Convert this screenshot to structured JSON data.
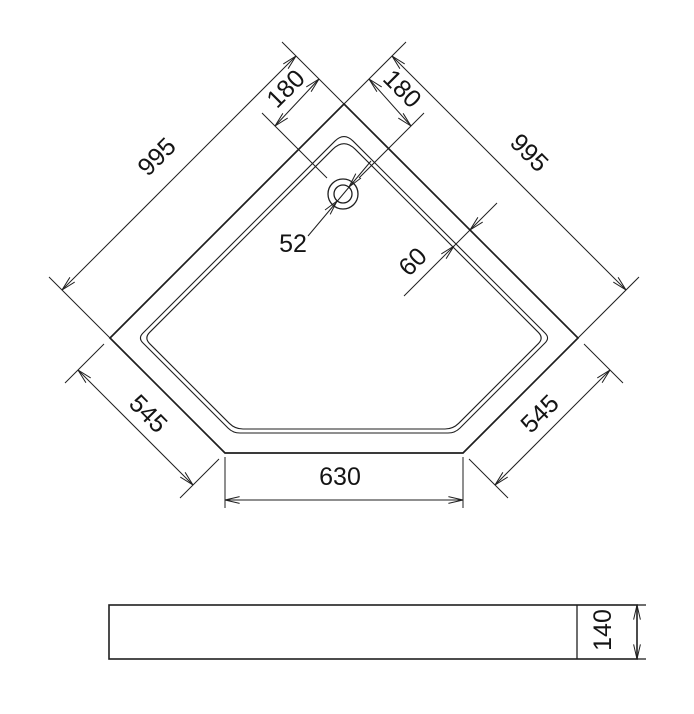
{
  "drawing": {
    "title": "corner shower tray dimension drawing",
    "colors": {
      "background": "#ffffff",
      "line": "#1f1f1f",
      "text": "#141414"
    },
    "dimensions": {
      "labels": {
        "side_995_left": "995",
        "side_995_right": "995",
        "offset_180_left": "180",
        "offset_180_right": "180",
        "chamfer_545_left": "545",
        "chamfer_545_right": "545",
        "front_630": "630",
        "drain_52": "52",
        "rim_60": "60",
        "height_140": "140"
      },
      "values": {
        "back_sides": 995,
        "drain_offset_each_side": 180,
        "chamfer_sides": 545,
        "front_edge": 630,
        "drain_diameter": 52,
        "rim_width": 60,
        "tray_height": 140
      }
    },
    "svg": {
      "width": 694,
      "height": 714,
      "font_size": 25,
      "arrow": {
        "length": 15,
        "half_angle_deg": 13
      },
      "primitives": [
        {
          "t": "path",
          "name": "tray-outline-outer",
          "d": "M344,104 L578,338 L463,453 L225,453 L110,338 Z",
          "sw": 1.7
        },
        {
          "t": "rpath",
          "name": "tray-rim-outer-line",
          "pts": [
            [
              344,
              132
            ],
            [
              550,
              338
            ],
            [
              455,
              433
            ],
            [
              233,
              433
            ],
            [
              138,
              338
            ]
          ],
          "r": [
            13,
            7,
            7,
            7,
            7
          ],
          "sw": 1.1
        },
        {
          "t": "rpath",
          "name": "tray-rim-inner-line",
          "pts": [
            [
              344,
              138
            ],
            [
              544,
              338
            ],
            [
              453,
              429
            ],
            [
              235,
              429
            ],
            [
              144,
              338
            ]
          ],
          "r": [
            16,
            8,
            8,
            8,
            8
          ],
          "sw": 1.1
        },
        {
          "t": "circle",
          "name": "drain-outer-circle",
          "c": [
            343,
            194
          ],
          "r": 15,
          "sw": 1.3
        },
        {
          "t": "circle",
          "name": "drain-inner-circle",
          "c": [
            343,
            194
          ],
          "r": 9,
          "sw": 1.3
        },
        {
          "t": "line",
          "name": "ext-line-apex-left",
          "p": [
            344,
            104,
            282,
            42
          ],
          "sw": 1
        },
        {
          "t": "line",
          "name": "ext-line-apex-right",
          "p": [
            344,
            104,
            406,
            42
          ],
          "sw": 1
        },
        {
          "t": "line",
          "name": "ext-line-drain-left",
          "p": [
            327,
            178,
            262,
            113
          ],
          "sw": 1
        },
        {
          "t": "line",
          "name": "ext-line-drain-right",
          "p": [
            359,
            178,
            424,
            113
          ],
          "sw": 1
        },
        {
          "t": "line",
          "name": "dim-line-180-left",
          "p": [
            275,
            126,
            319,
            79
          ],
          "sw": 1
        },
        {
          "t": "line",
          "name": "dim-line-180-right",
          "p": [
            369,
            79,
            411,
            126
          ],
          "sw": 1
        },
        {
          "t": "line",
          "name": "dim-line-995-left",
          "p": [
            62,
            290,
            296,
            56
          ],
          "sw": 1
        },
        {
          "t": "line",
          "name": "ext-line-995-left-vertex",
          "p": [
            110,
            338,
            49,
            277
          ],
          "sw": 1
        },
        {
          "t": "line",
          "name": "dim-line-995-right",
          "p": [
            392,
            56,
            626,
            290
          ],
          "sw": 1
        },
        {
          "t": "line",
          "name": "ext-line-995-right-vertex",
          "p": [
            578,
            338,
            639,
            277
          ],
          "sw": 1
        },
        {
          "t": "line",
          "name": "dim-line-545-left",
          "p": [
            78,
            370,
            193,
            485
          ],
          "sw": 1
        },
        {
          "t": "line",
          "name": "ext-line-545-left-top",
          "p": [
            104,
            344,
            65,
            383
          ],
          "sw": 1
        },
        {
          "t": "line",
          "name": "ext-line-545-left-bottom",
          "p": [
            219,
            459,
            180,
            498
          ],
          "sw": 1
        },
        {
          "t": "line",
          "name": "dim-line-545-right",
          "p": [
            610,
            370,
            495,
            485
          ],
          "sw": 1
        },
        {
          "t": "line",
          "name": "ext-line-545-right-top",
          "p": [
            584,
            344,
            623,
            383
          ],
          "sw": 1
        },
        {
          "t": "line",
          "name": "ext-line-545-right-bottom",
          "p": [
            469,
            459,
            508,
            498
          ],
          "sw": 1
        },
        {
          "t": "line",
          "name": "ext-line-630-left",
          "p": [
            225,
            457,
            225,
            508
          ],
          "sw": 1
        },
        {
          "t": "line",
          "name": "ext-line-630-right",
          "p": [
            463,
            457,
            463,
            508
          ],
          "sw": 1
        },
        {
          "t": "line",
          "name": "dim-line-630",
          "p": [
            225,
            500,
            463,
            500
          ],
          "sw": 1
        },
        {
          "t": "line",
          "name": "leader-line-52",
          "p": [
            308,
            236,
            371,
            161
          ],
          "sw": 1
        },
        {
          "t": "line",
          "name": "dim-line-60",
          "p": [
            404,
            296,
            497,
            203
          ],
          "sw": 1
        },
        {
          "t": "arrow",
          "name": "arrowhead-995-left-top",
          "tip": [
            296,
            56
          ],
          "a": -45
        },
        {
          "t": "arrow",
          "name": "arrowhead-995-left-bottom",
          "tip": [
            62,
            290
          ],
          "a": 135
        },
        {
          "t": "arrow",
          "name": "arrowhead-995-right-top",
          "tip": [
            392,
            56
          ],
          "a": -135
        },
        {
          "t": "arrow",
          "name": "arrowhead-995-right-bottom",
          "tip": [
            626,
            290
          ],
          "a": 45
        },
        {
          "t": "arrow",
          "name": "arrowhead-180-left-top",
          "tip": [
            319,
            79
          ],
          "a": -45
        },
        {
          "t": "arrow",
          "name": "arrowhead-180-left-bottom",
          "tip": [
            275,
            126
          ],
          "a": 135
        },
        {
          "t": "arrow",
          "name": "arrowhead-180-right-top",
          "tip": [
            369,
            79
          ],
          "a": -135
        },
        {
          "t": "arrow",
          "name": "arrowhead-180-right-bottom",
          "tip": [
            411,
            126
          ],
          "a": 45
        },
        {
          "t": "arrow",
          "name": "arrowhead-545-left-top",
          "tip": [
            78,
            370
          ],
          "a": -135
        },
        {
          "t": "arrow",
          "name": "arrowhead-545-left-bottom",
          "tip": [
            193,
            485
          ],
          "a": 45
        },
        {
          "t": "arrow",
          "name": "arrowhead-545-right-top",
          "tip": [
            610,
            370
          ],
          "a": -45
        },
        {
          "t": "arrow",
          "name": "arrowhead-545-right-bottom",
          "tip": [
            495,
            485
          ],
          "a": 135
        },
        {
          "t": "arrow",
          "name": "arrowhead-630-left",
          "tip": [
            225,
            500
          ],
          "a": 180
        },
        {
          "t": "arrow",
          "name": "arrowhead-630-right",
          "tip": [
            463,
            500
          ],
          "a": 0
        },
        {
          "t": "arrow",
          "name": "arrowhead-52-lower",
          "tip": [
            337,
            201
          ],
          "a": -50
        },
        {
          "t": "arrow",
          "name": "arrowhead-52-upper",
          "tip": [
            349,
            187
          ],
          "a": 130
        },
        {
          "t": "arrow",
          "name": "arrowhead-60-outer",
          "tip": [
            470,
            230
          ],
          "a": 135
        },
        {
          "t": "arrow",
          "name": "arrowhead-60-inner",
          "tip": [
            454,
            246
          ],
          "a": -45
        },
        {
          "t": "rect",
          "name": "side-view-body",
          "x": 109,
          "y": 605,
          "w": 528,
          "h": 54,
          "sw": 1.6
        },
        {
          "t": "line",
          "name": "side-view-divider",
          "p": [
            577,
            605,
            577,
            659
          ],
          "sw": 1.3
        },
        {
          "t": "line",
          "name": "side-view-top-overshoot",
          "p": [
            637,
            605,
            646,
            605
          ],
          "sw": 1.3
        },
        {
          "t": "line",
          "name": "side-view-bottom-overshoot",
          "p": [
            637,
            659,
            646,
            659
          ],
          "sw": 1.3
        },
        {
          "t": "line",
          "name": "dim-line-140",
          "p": [
            637,
            605,
            637,
            659
          ],
          "sw": 1
        },
        {
          "t": "arrow",
          "name": "arrowhead-140-top",
          "tip": [
            637,
            605
          ],
          "a": -90
        },
        {
          "t": "arrow",
          "name": "arrowhead-140-bottom",
          "tip": [
            637,
            659
          ],
          "a": 90
        },
        {
          "t": "text",
          "name": "dim-label-995-left",
          "c": [
            157,
            157
          ],
          "rot": -45,
          "bind": "drawing.dimensions.labels.side_995_left"
        },
        {
          "t": "text",
          "name": "dim-label-995-right",
          "c": [
            529,
            153
          ],
          "rot": 45,
          "bind": "drawing.dimensions.labels.side_995_right"
        },
        {
          "t": "text",
          "name": "dim-label-180-left",
          "c": [
            286,
            89
          ],
          "rot": -45,
          "bind": "drawing.dimensions.labels.offset_180_left"
        },
        {
          "t": "text",
          "name": "dim-label-180-right",
          "c": [
            402,
            89
          ],
          "rot": 45,
          "bind": "drawing.dimensions.labels.offset_180_right"
        },
        {
          "t": "text",
          "name": "dim-label-545-left",
          "c": [
            148,
            414
          ],
          "rot": 45,
          "bind": "drawing.dimensions.labels.chamfer_545_left"
        },
        {
          "t": "text",
          "name": "dim-label-545-right",
          "c": [
            540,
            414
          ],
          "rot": -45,
          "bind": "drawing.dimensions.labels.chamfer_545_right"
        },
        {
          "t": "text",
          "name": "dim-label-630",
          "c": [
            340,
            477
          ],
          "rot": 0,
          "bind": "drawing.dimensions.labels.front_630"
        },
        {
          "t": "text",
          "name": "dim-label-52",
          "c": [
            293,
            244
          ],
          "rot": 0,
          "bind": "drawing.dimensions.labels.drain_52"
        },
        {
          "t": "text",
          "name": "dim-label-60",
          "c": [
            413,
            262
          ],
          "rot": -45,
          "bind": "drawing.dimensions.labels.rim_60"
        },
        {
          "t": "text",
          "name": "dim-label-140",
          "c": [
            603,
            630
          ],
          "rot": -90,
          "bind": "drawing.dimensions.labels.height_140"
        }
      ]
    }
  }
}
